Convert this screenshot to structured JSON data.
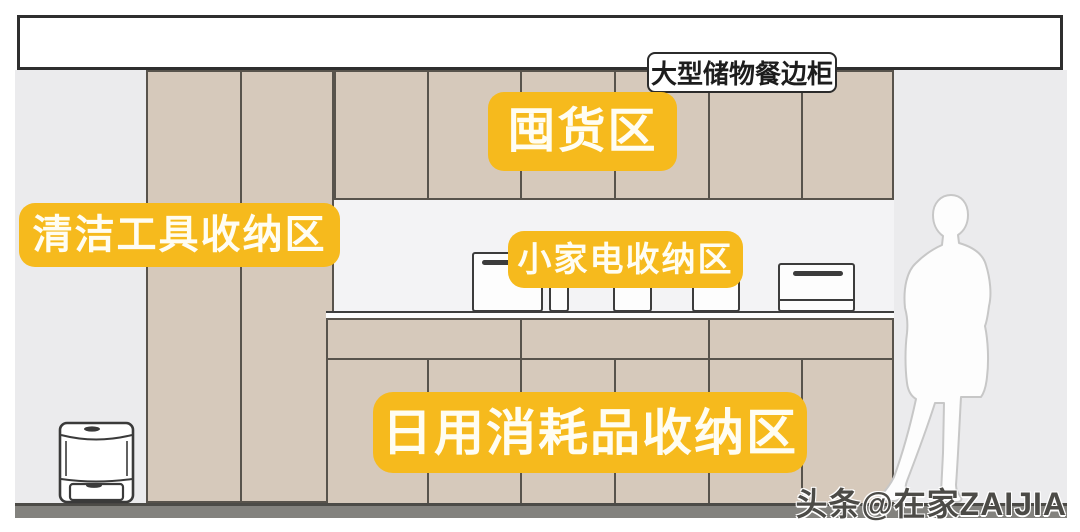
{
  "callout": {
    "text": "大型储物餐边柜"
  },
  "labels": {
    "stockpile": {
      "text": "囤货区"
    },
    "cleaning_tools": {
      "text": "清洁工具收纳区"
    },
    "small_appliance": {
      "text": "小家电收纳区"
    },
    "daily_consumables": {
      "text": "日用消耗品收纳区"
    }
  },
  "watermark": {
    "text": "头条@在家ZAIJIA"
  },
  "scene": {
    "objects": [
      "soffit",
      "tall-cabinet",
      "upper-cabinet",
      "lower-cabinet",
      "countertop",
      "microwave",
      "canisters",
      "countertop-oven",
      "trash-bin",
      "person-silhouette",
      "floor"
    ]
  },
  "colors": {
    "accent_yellow": "#f6ba1d",
    "label_text": "#fffdf2",
    "cabinet_tan": "#d6c9bb",
    "cabinet_line": "#58534c",
    "wall_gray": "#ebebed",
    "niche_gray": "#f3f3f5",
    "floor_gray": "#83827e",
    "callout_border": "#2b2b2b"
  }
}
